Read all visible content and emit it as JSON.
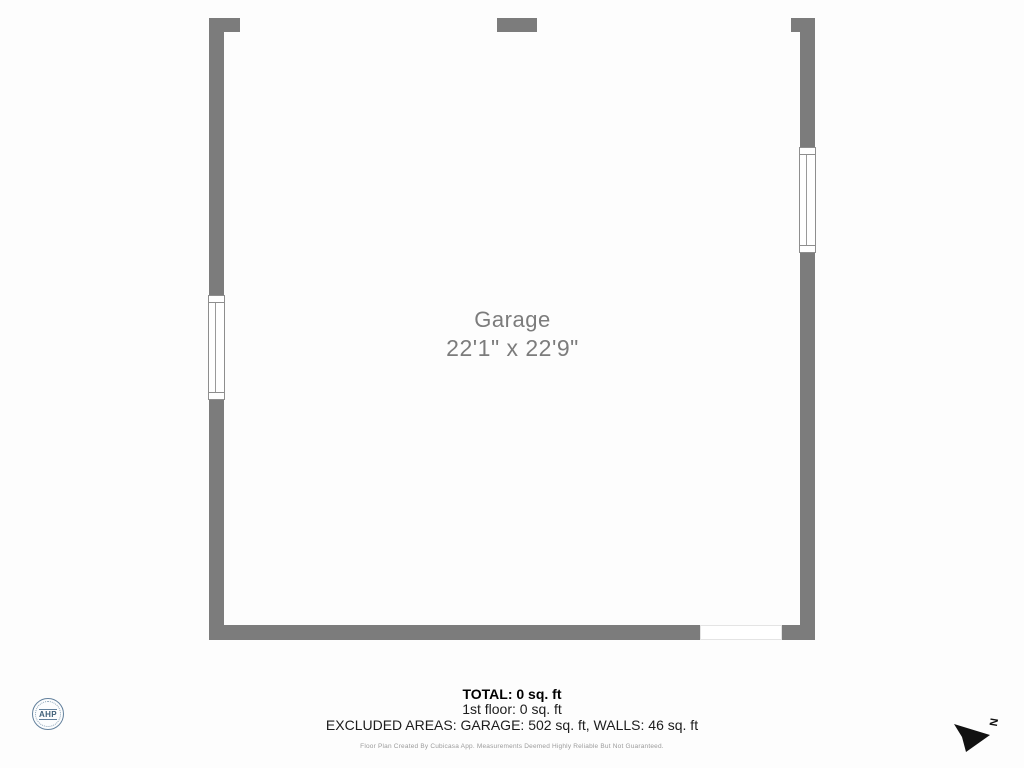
{
  "floor_plan": {
    "room": {
      "name": "Garage",
      "dimensions": "22'1\" x 22'9\""
    },
    "wall_color": "#7c7c7c",
    "window_border_color": "#8e8e8e"
  },
  "footer": {
    "total": "TOTAL: 0 sq. ft",
    "first_floor": "1st floor: 0 sq. ft",
    "excluded_areas": "EXCLUDED AREAS: GARAGE: 502 sq. ft, WALLS: 46 sq. ft",
    "disclaimer": "Floor Plan Created By Cubicasa App. Measurements Deemed Highly Reliable But Not Guaranteed."
  },
  "logo": {
    "text": "AHP",
    "color": "#3f6079"
  },
  "compass": {
    "letter": "N",
    "arrow_color": "#111111"
  }
}
